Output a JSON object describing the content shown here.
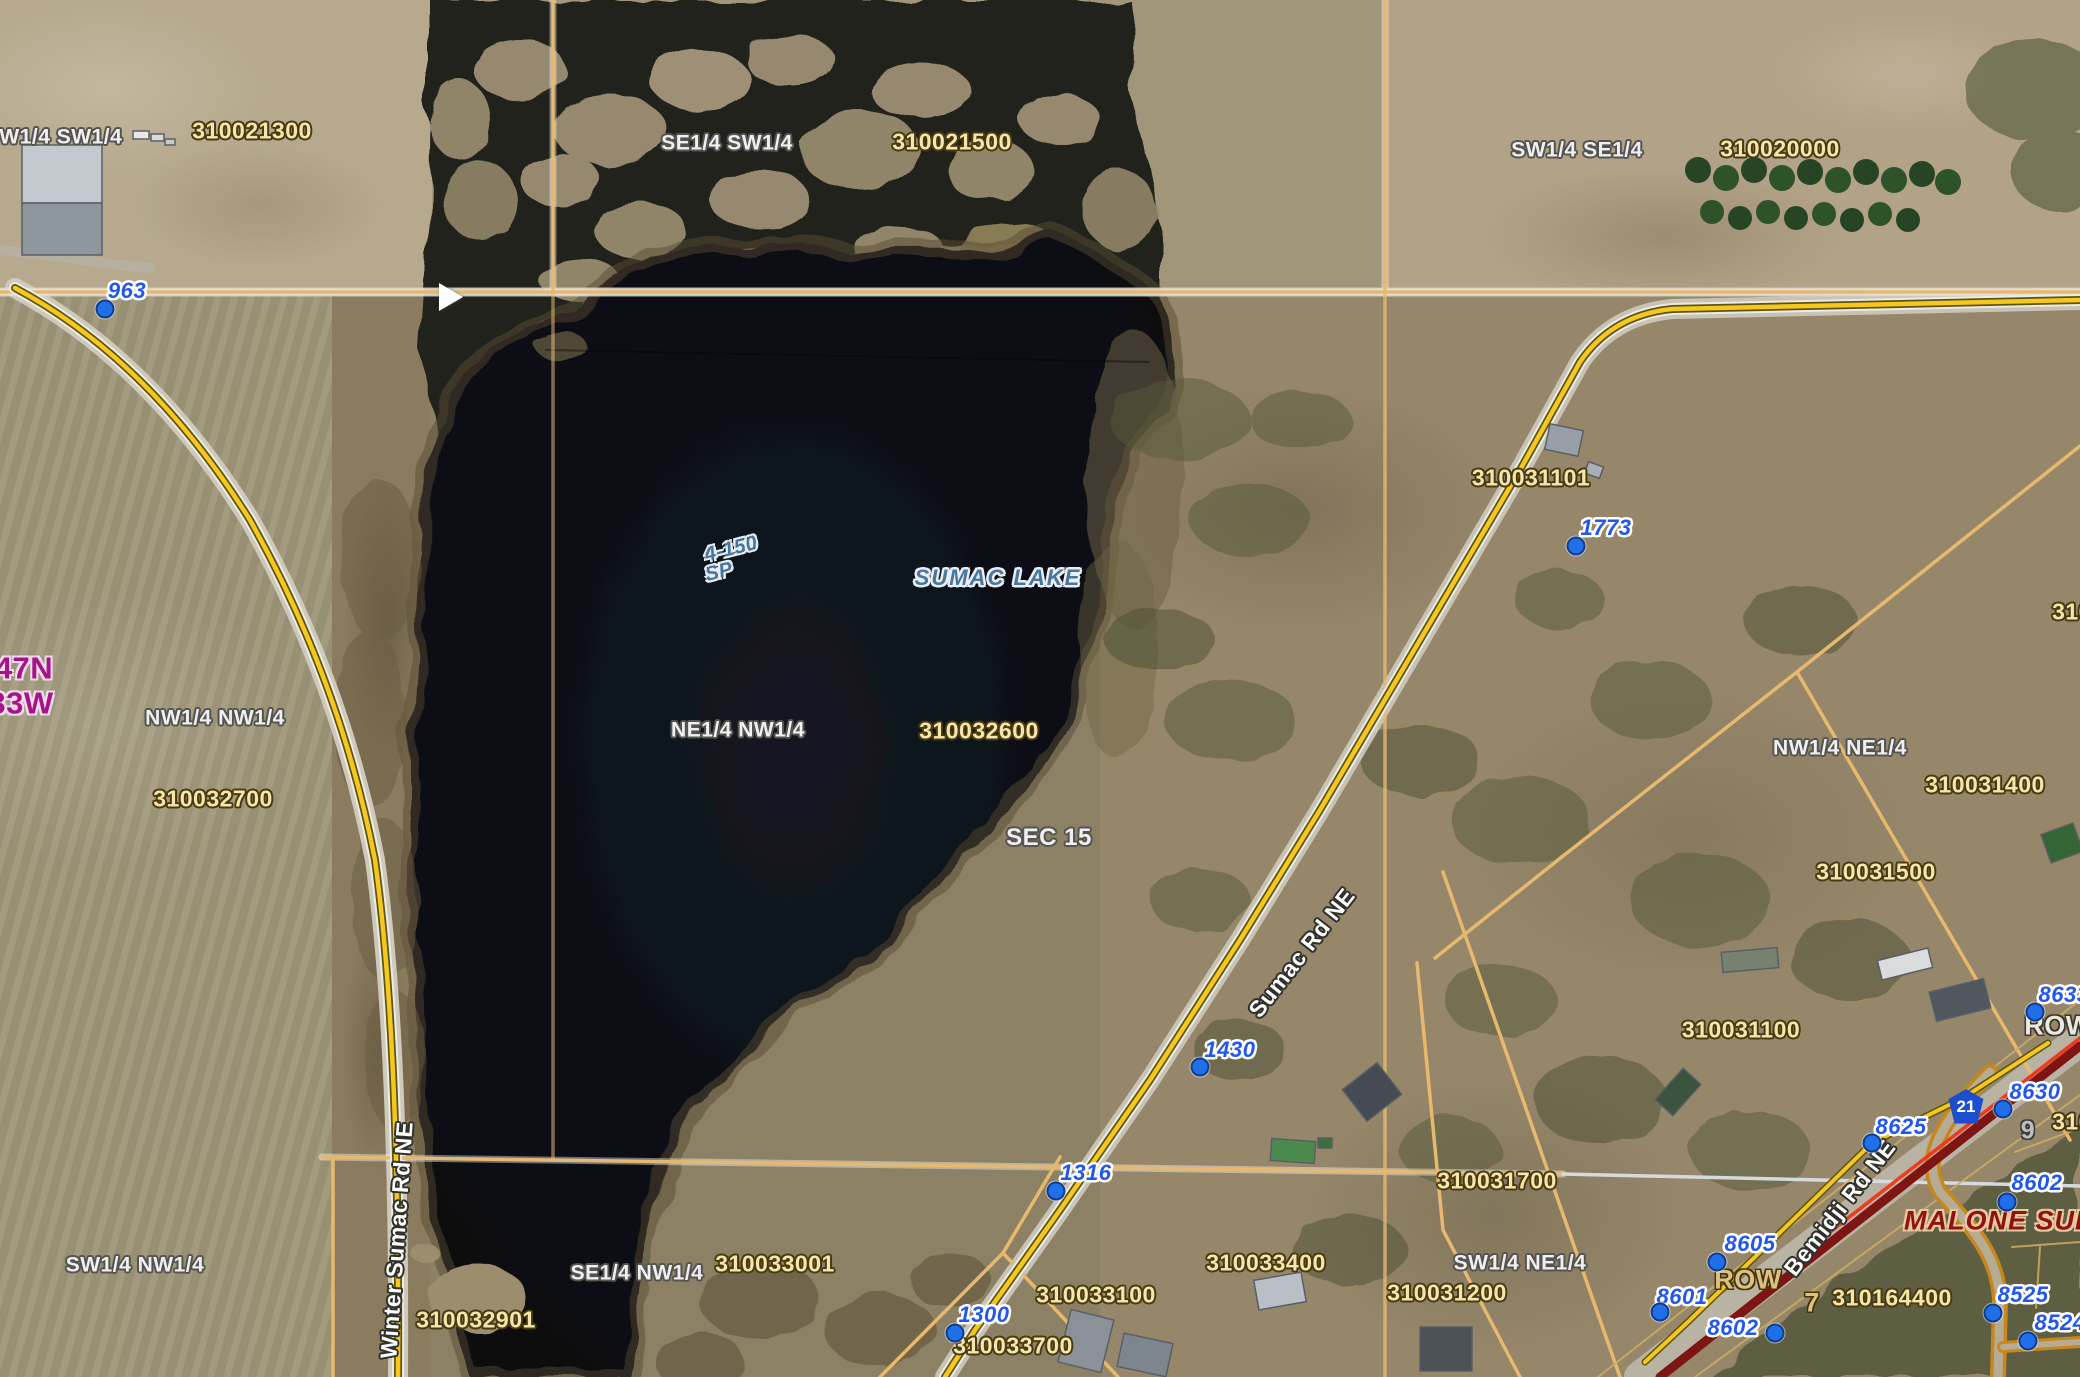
{
  "map": {
    "title": "County parcel viewer aerial map of Sumac Lake, Section 15",
    "labels": [
      {
        "t": "310021300",
        "x": 252,
        "y": 131,
        "c": "parcel"
      },
      {
        "t": "310021500",
        "x": 952,
        "y": 142,
        "c": "parcel"
      },
      {
        "t": "310020000",
        "x": 1780,
        "y": 149,
        "c": "parcel"
      },
      {
        "t": "310032700",
        "x": 213,
        "y": 799,
        "c": "parcel"
      },
      {
        "t": "310032600",
        "x": 979,
        "y": 731,
        "c": "parcel"
      },
      {
        "t": "310031101",
        "x": 1531,
        "y": 478,
        "c": "parcel"
      },
      {
        "t": "310031400",
        "x": 1985,
        "y": 785,
        "c": "parcel"
      },
      {
        "t": "310031500",
        "x": 1876,
        "y": 872,
        "c": "parcel"
      },
      {
        "t": "310031100",
        "x": 1741,
        "y": 1030,
        "c": "parcel"
      },
      {
        "t": "310031700",
        "x": 1497,
        "y": 1181,
        "c": "parcel"
      },
      {
        "t": "310033400",
        "x": 1266,
        "y": 1263,
        "c": "parcel"
      },
      {
        "t": "310033100",
        "x": 1096,
        "y": 1295,
        "c": "parcel"
      },
      {
        "t": "310031200",
        "x": 1447,
        "y": 1293,
        "c": "parcel"
      },
      {
        "t": "310033001",
        "x": 775,
        "y": 1264,
        "c": "parcel"
      },
      {
        "t": "310032901",
        "x": 476,
        "y": 1320,
        "c": "parcel"
      },
      {
        "t": "310033700",
        "x": 1013,
        "y": 1346,
        "c": "parcel"
      },
      {
        "t": "310164400",
        "x": 1892,
        "y": 1298,
        "c": "parcel"
      },
      {
        "t": "310",
        "x": 2072,
        "y": 612,
        "c": "parcel"
      },
      {
        "t": "310",
        "x": 2072,
        "y": 1122,
        "c": "parcel"
      },
      {
        "t": "NW1/4 SW1/4",
        "x": 53,
        "y": 137,
        "c": "quarter"
      },
      {
        "t": "SE1/4 SW1/4",
        "x": 727,
        "y": 143,
        "c": "quarter"
      },
      {
        "t": "SW1/4 SE1/4",
        "x": 1577,
        "y": 150,
        "c": "quarter"
      },
      {
        "t": "NW1/4 NW1/4",
        "x": 215,
        "y": 718,
        "c": "quarter"
      },
      {
        "t": "NE1/4 NW1/4",
        "x": 738,
        "y": 730,
        "c": "quarter"
      },
      {
        "t": "SW1/4 NW1/4",
        "x": 135,
        "y": 1265,
        "c": "quarter"
      },
      {
        "t": "SE1/4 NW1/4",
        "x": 637,
        "y": 1273,
        "c": "quarter"
      },
      {
        "t": "NW1/4 NE1/4",
        "x": 1840,
        "y": 748,
        "c": "quarter"
      },
      {
        "t": "SW1/4 NE1/4",
        "x": 1520,
        "y": 1263,
        "c": "quarter"
      },
      {
        "t": "SEC 15",
        "x": 1049,
        "y": 838,
        "c": "section"
      },
      {
        "t": "47N",
        "x": 24,
        "y": 668,
        "c": "tr"
      },
      {
        "t": "33W",
        "x": 21,
        "y": 703,
        "c": "tr"
      },
      {
        "t": "963",
        "x": 127,
        "y": 291,
        "c": "address"
      },
      {
        "t": "1773",
        "x": 1606,
        "y": 528,
        "c": "address"
      },
      {
        "t": "1430",
        "x": 1230,
        "y": 1050,
        "c": "address"
      },
      {
        "t": "1316",
        "x": 1086,
        "y": 1173,
        "c": "address"
      },
      {
        "t": "1300",
        "x": 984,
        "y": 1315,
        "c": "address"
      },
      {
        "t": "8633",
        "x": 2064,
        "y": 995,
        "c": "address"
      },
      {
        "t": "8630",
        "x": 2035,
        "y": 1092,
        "c": "address"
      },
      {
        "t": "8625",
        "x": 1901,
        "y": 1127,
        "c": "address"
      },
      {
        "t": "8602",
        "x": 2037,
        "y": 1183,
        "c": "address"
      },
      {
        "t": "8605",
        "x": 1750,
        "y": 1244,
        "c": "address"
      },
      {
        "t": "8601",
        "x": 1682,
        "y": 1297,
        "c": "address"
      },
      {
        "t": "8602",
        "x": 1733,
        "y": 1328,
        "c": "address"
      },
      {
        "t": "8525",
        "x": 2023,
        "y": 1295,
        "c": "address"
      },
      {
        "t": "8524",
        "x": 2060,
        "y": 1323,
        "c": "address"
      },
      {
        "t": "Winter Sumac Rd NE",
        "x": 397,
        "y": 1240,
        "r": -86,
        "c": "road"
      },
      {
        "t": "Sumac Rd NE",
        "x": 1302,
        "y": 953,
        "r": -52,
        "c": "road"
      },
      {
        "t": "Bemidji Rd NE",
        "x": 1840,
        "y": 1208,
        "r": -52,
        "c": "road"
      },
      {
        "t": "SUMAC LAKE",
        "x": 998,
        "y": 578,
        "c": "lake"
      },
      {
        "t": "4-150",
        "x": 731,
        "y": 549,
        "r": -14,
        "c": "lakesm"
      },
      {
        "t": "SP",
        "x": 719,
        "y": 572,
        "r": -14,
        "c": "lakesm"
      },
      {
        "t": "MALONE SUBD",
        "x": 2010,
        "y": 1221,
        "c": "subd"
      },
      {
        "t": "ROW",
        "x": 2058,
        "y": 1026,
        "c": "roww"
      },
      {
        "t": "ROW",
        "x": 1748,
        "y": 1280,
        "c": "rowt"
      },
      {
        "t": "9",
        "x": 2028,
        "y": 1131,
        "c": "lotg"
      },
      {
        "t": "7",
        "x": 1812,
        "y": 1303,
        "c": "lott"
      },
      {
        "t": "21",
        "x": 1966,
        "y": 1107,
        "c": "shield"
      }
    ],
    "address_points": [
      {
        "x": 105,
        "y": 309
      },
      {
        "x": 1576,
        "y": 546
      },
      {
        "x": 1200,
        "y": 1067
      },
      {
        "x": 1056,
        "y": 1191
      },
      {
        "x": 955,
        "y": 1333
      },
      {
        "x": 2035,
        "y": 1012
      },
      {
        "x": 2003,
        "y": 1109
      },
      {
        "x": 1872,
        "y": 1143
      },
      {
        "x": 2007,
        "y": 1202
      },
      {
        "x": 1717,
        "y": 1262
      },
      {
        "x": 1660,
        "y": 1312
      },
      {
        "x": 1775,
        "y": 1333
      },
      {
        "x": 1993,
        "y": 1313
      },
      {
        "x": 2028,
        "y": 1341
      }
    ],
    "cursor": {
      "x": 441,
      "y": 297
    },
    "colors": {
      "parcel_text": "#f6e6ad",
      "parcel_line": "#e6b96f",
      "quarter_text": "#f0f0f4",
      "address_text": "#2257ee",
      "address_dot": "#1f6fe8",
      "township_text": "#a81387",
      "lake_text": "#49759e",
      "road_yellow": "#f6c81e",
      "highway_red": "#7f1512",
      "highway_bright": "#ef3b1c",
      "subd_road": "#c6871c",
      "subd_text": "#8f1410",
      "water": "#0b0e15",
      "shield_blue": "#1d4ed0"
    }
  }
}
